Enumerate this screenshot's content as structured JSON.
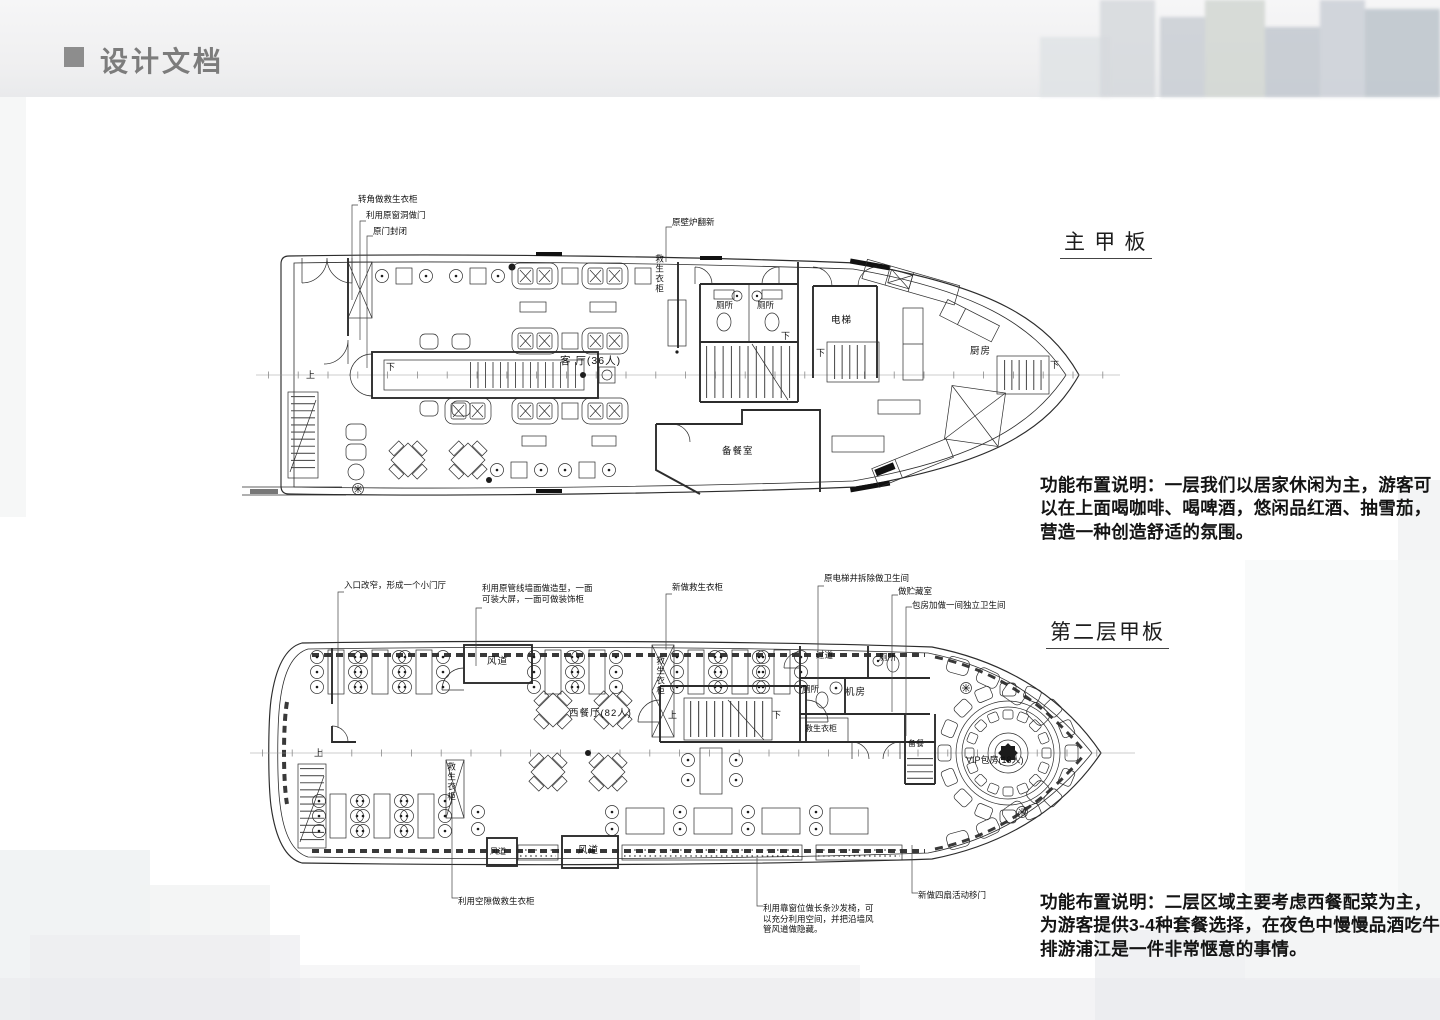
{
  "header": {
    "title": "设计文档"
  },
  "notes": {
    "deck1": "功能布置说明：一层我们以居家休闲为主，游客可\n以在上面喝咖啡、喝啤酒，悠闲品红酒、抽雪茄，\n营造一种创造舒适的氛围。",
    "deck2": "功能布置说明：二层区域主要考虑西餐配菜为主，\n为游客提供3-4种套餐选择，在夜色中慢慢品酒吃牛\n排游浦江是一件非常惬意的事情。"
  },
  "deck1": {
    "title": "主 甲 板",
    "labels": {
      "corner_cabinet": "转角做救生衣柜",
      "window_door": "利用原窗洞做门",
      "door_closed": "原门封闭",
      "fireplace": "原壁炉翻新",
      "life_jacket": "救生衣柜",
      "toilet": "厕所",
      "elevator": "电梯",
      "living_room": "客 厅(36人)",
      "pantry": "备餐室",
      "kitchen": "厨房"
    }
  },
  "deck2": {
    "title": "第二层甲板",
    "labels": {
      "entrance": "入口改窄，形成一个小门厅",
      "pipeline_wall": "利用原管线墙面做造型，一面\n可装大屏，一面可做装饰柜",
      "new_life_cabinet": "新做救生衣柜",
      "elevator_shaft": "原电梯井拆除做卫生间",
      "storage": "做贮藏室",
      "private_bathroom": "包房加做一间独立卫生间",
      "duct": "风道",
      "corridor": "过道",
      "toilet": "厕所",
      "machine_room": "机房",
      "life_jacket": "救生衣柜",
      "restaurant": "西餐厅(82人)",
      "food_prep": "备餐",
      "vip_room": "VIP包房(18人)",
      "gap_cabinet": "利用空隙做救生衣柜",
      "window_sofa": "利用靠窗位做长条沙发椅，可\n以充分利用空间，并把沿墙风\n管风道做隐藏。",
      "sliding_doors": "新做四扇活动移门"
    }
  },
  "markers": {
    "up": "上",
    "down": "下"
  }
}
